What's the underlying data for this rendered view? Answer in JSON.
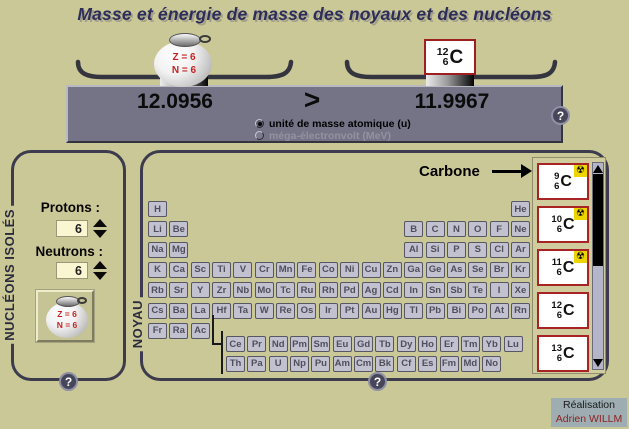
{
  "title": "Masse et énergie de masse des noyaux et des nucléons",
  "ui": {
    "help_glyph": "?",
    "radioactive_glyph": "☢",
    "accent_red": "#a82424",
    "background": "#cbc897",
    "panel_gray": "#757487"
  },
  "balance": {
    "left_value": "12.0956",
    "comparator": ">",
    "right_value": "11.9967",
    "bag": {
      "line1": "Z = 6",
      "line2": "N = 6"
    },
    "nuclide": {
      "mass": "12",
      "z": "6",
      "symbol": "C"
    },
    "units": [
      {
        "label": "unité de masse atomique (u)",
        "selected": true
      },
      {
        "label": "méga-électronvolt (MeV)",
        "selected": false
      }
    ]
  },
  "nucleons_panel": {
    "title": "NUCLÉONS ISOLÉS",
    "protons_label": "Protons :",
    "protons_value": "6",
    "neutrons_label": "Neutrons :",
    "neutrons_value": "6",
    "bag": {
      "line1": "Z = 6",
      "line2": "N = 6"
    }
  },
  "noyau_panel": {
    "title": "NOYAU",
    "selected_element_label": "Carbone",
    "periodic_table": {
      "rows": [
        [
          {
            "s": "H",
            "c": 1
          },
          {
            "s": "He",
            "c": 18
          }
        ],
        [
          {
            "s": "Li",
            "c": 1
          },
          {
            "s": "Be",
            "c": 2
          },
          {
            "s": "B",
            "c": 13
          },
          {
            "s": "C",
            "c": 14
          },
          {
            "s": "N",
            "c": 15
          },
          {
            "s": "O",
            "c": 16
          },
          {
            "s": "F",
            "c": 17
          },
          {
            "s": "Ne",
            "c": 18
          }
        ],
        [
          {
            "s": "Na",
            "c": 1
          },
          {
            "s": "Mg",
            "c": 2
          },
          {
            "s": "Al",
            "c": 13
          },
          {
            "s": "Si",
            "c": 14
          },
          {
            "s": "P",
            "c": 15
          },
          {
            "s": "S",
            "c": 16
          },
          {
            "s": "Cl",
            "c": 17
          },
          {
            "s": "Ar",
            "c": 18
          }
        ],
        [
          {
            "s": "K",
            "c": 1
          },
          {
            "s": "Ca",
            "c": 2
          },
          {
            "s": "Sc",
            "c": 3
          },
          {
            "s": "Ti",
            "c": 4
          },
          {
            "s": "V",
            "c": 5
          },
          {
            "s": "Cr",
            "c": 6
          },
          {
            "s": "Mn",
            "c": 7
          },
          {
            "s": "Fe",
            "c": 8
          },
          {
            "s": "Co",
            "c": 9
          },
          {
            "s": "Ni",
            "c": 10
          },
          {
            "s": "Cu",
            "c": 11
          },
          {
            "s": "Zn",
            "c": 12
          },
          {
            "s": "Ga",
            "c": 13
          },
          {
            "s": "Ge",
            "c": 14
          },
          {
            "s": "As",
            "c": 15
          },
          {
            "s": "Se",
            "c": 16
          },
          {
            "s": "Br",
            "c": 17
          },
          {
            "s": "Kr",
            "c": 18
          }
        ],
        [
          {
            "s": "Rb",
            "c": 1
          },
          {
            "s": "Sr",
            "c": 2
          },
          {
            "s": "Y",
            "c": 3
          },
          {
            "s": "Zr",
            "c": 4
          },
          {
            "s": "Nb",
            "c": 5
          },
          {
            "s": "Mo",
            "c": 6
          },
          {
            "s": "Tc",
            "c": 7
          },
          {
            "s": "Ru",
            "c": 8
          },
          {
            "s": "Rh",
            "c": 9
          },
          {
            "s": "Pd",
            "c": 10
          },
          {
            "s": "Ag",
            "c": 11
          },
          {
            "s": "Cd",
            "c": 12
          },
          {
            "s": "In",
            "c": 13
          },
          {
            "s": "Sn",
            "c": 14
          },
          {
            "s": "Sb",
            "c": 15
          },
          {
            "s": "Te",
            "c": 16
          },
          {
            "s": "I",
            "c": 17
          },
          {
            "s": "Xe",
            "c": 18
          }
        ],
        [
          {
            "s": "Cs",
            "c": 1
          },
          {
            "s": "Ba",
            "c": 2
          },
          {
            "s": "La",
            "c": 3
          },
          {
            "s": "Hf",
            "c": 4
          },
          {
            "s": "Ta",
            "c": 5
          },
          {
            "s": "W",
            "c": 6
          },
          {
            "s": "Re",
            "c": 7
          },
          {
            "s": "Os",
            "c": 8
          },
          {
            "s": "Ir",
            "c": 9
          },
          {
            "s": "Pt",
            "c": 10
          },
          {
            "s": "Au",
            "c": 11
          },
          {
            "s": "Hg",
            "c": 12
          },
          {
            "s": "Tl",
            "c": 13
          },
          {
            "s": "Pb",
            "c": 14
          },
          {
            "s": "Bi",
            "c": 15
          },
          {
            "s": "Po",
            "c": 16
          },
          {
            "s": "At",
            "c": 17
          },
          {
            "s": "Rn",
            "c": 18
          }
        ],
        [
          {
            "s": "Fr",
            "c": 1
          },
          {
            "s": "Ra",
            "c": 2
          },
          {
            "s": "Ac",
            "c": 3
          }
        ]
      ],
      "lanthanides": [
        "Ce",
        "Pr",
        "Nd",
        "Pm",
        "Sm",
        "Eu",
        "Gd",
        "Tb",
        "Dy",
        "Ho",
        "Er",
        "Tm",
        "Yb",
        "Lu"
      ],
      "actinides": [
        "Th",
        "Pa",
        "U",
        "Np",
        "Pu",
        "Am",
        "Cm",
        "Bk",
        "Cf",
        "Es",
        "Fm",
        "Md",
        "No"
      ]
    },
    "isotopes": [
      {
        "mass": "9",
        "z": "6",
        "symbol": "C",
        "radioactive": true
      },
      {
        "mass": "10",
        "z": "6",
        "symbol": "C",
        "radioactive": true
      },
      {
        "mass": "11",
        "z": "6",
        "symbol": "C",
        "radioactive": true
      },
      {
        "mass": "12",
        "z": "6",
        "symbol": "C",
        "radioactive": false
      },
      {
        "mass": "13",
        "z": "6",
        "symbol": "C",
        "radioactive": false
      }
    ]
  },
  "credit": {
    "line1": "Réalisation",
    "line2": "Adrien WILLM"
  }
}
